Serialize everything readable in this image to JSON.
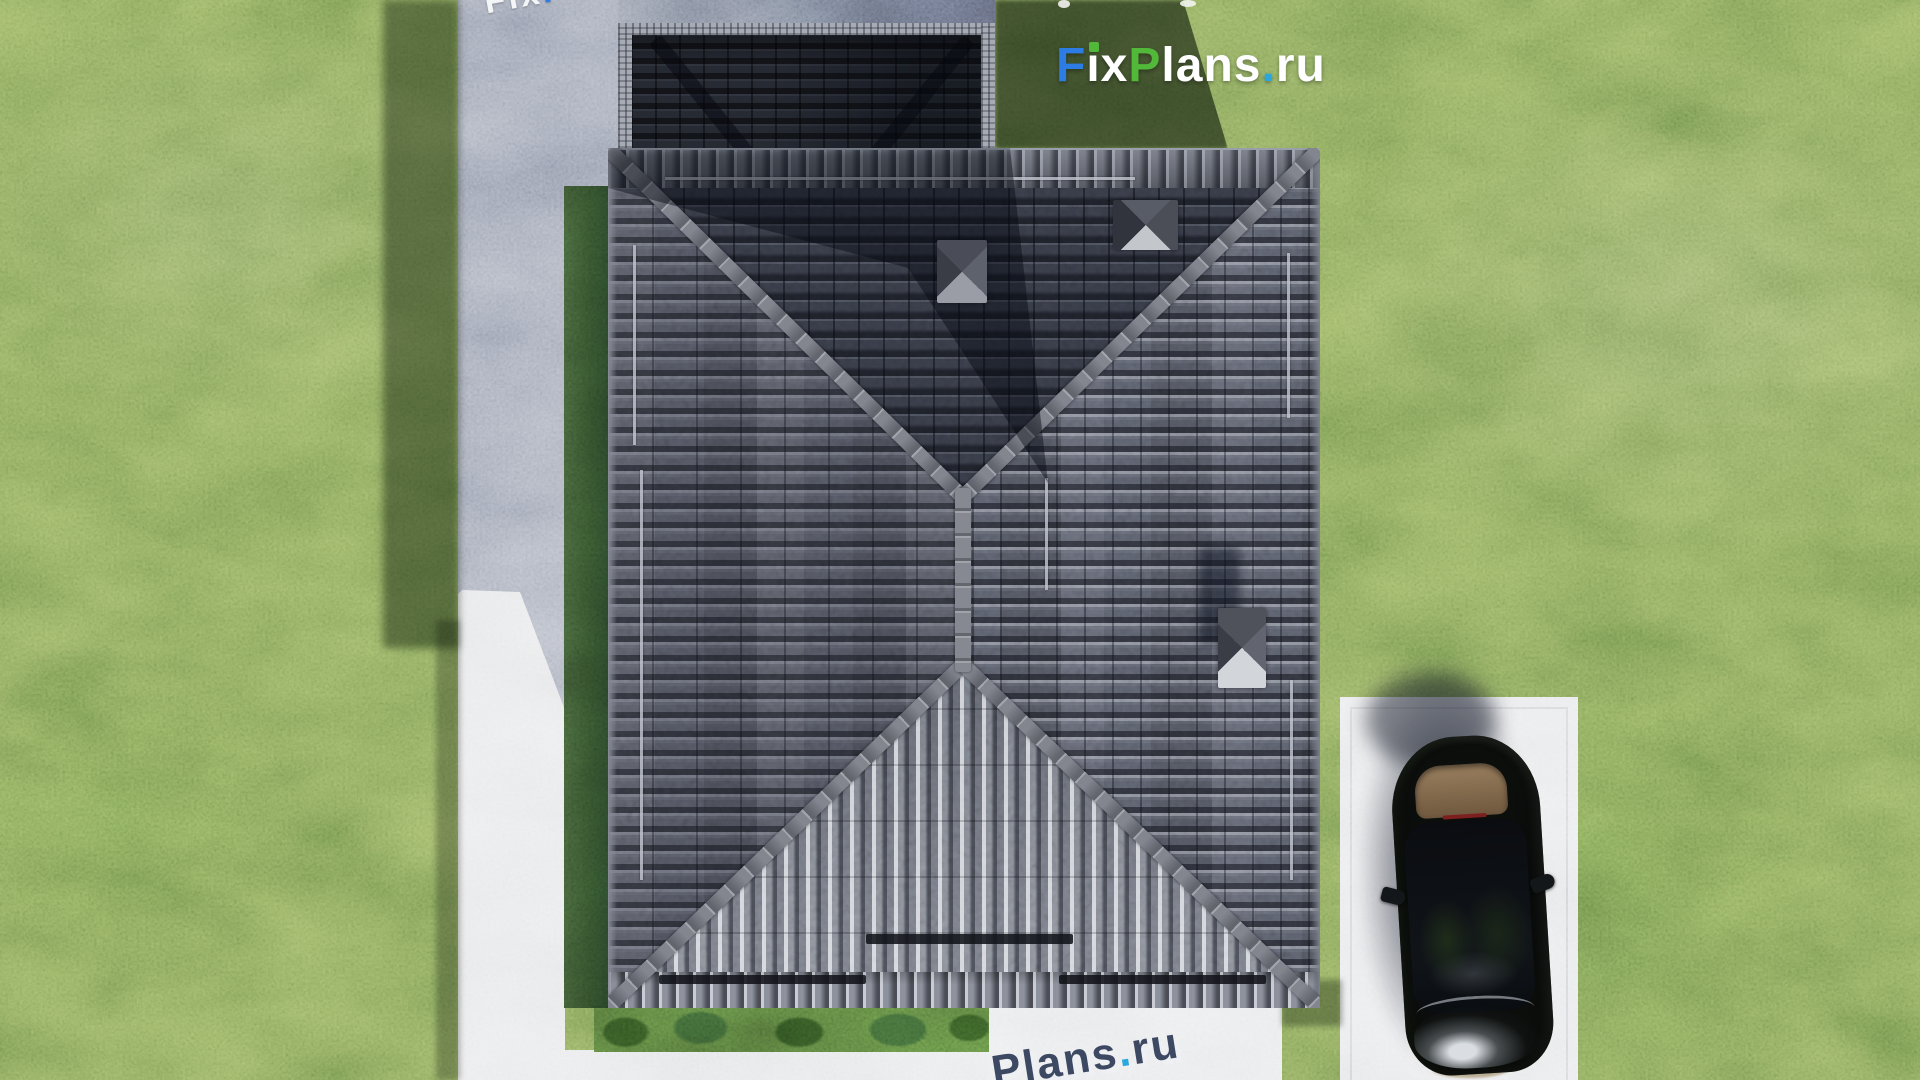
{
  "watermarks": {
    "main": {
      "text": "FixPlans.ru",
      "letters": [
        {
          "ch": "F",
          "color": "#2d7ce4"
        },
        {
          "ch": "i",
          "color": "#ffffff",
          "dot_color": "#52b83a"
        },
        {
          "ch": "x",
          "color": "#ffffff"
        },
        {
          "ch": "P",
          "color": "#52b83a"
        },
        {
          "ch": "l",
          "color": "#ffffff"
        },
        {
          "ch": "a",
          "color": "#ffffff"
        },
        {
          "ch": "n",
          "color": "#ffffff"
        },
        {
          "ch": "s",
          "color": "#ffffff"
        },
        {
          "ch": ".",
          "color": "#2aa7df"
        },
        {
          "ch": "r",
          "color": "#ffffff"
        },
        {
          "ch": "u",
          "color": "#ffffff"
        }
      ]
    },
    "top_left": {
      "text": "FixPlans.ru",
      "letters": [
        {
          "ch": "F",
          "color": "#f4f5f7"
        },
        {
          "ch": "i",
          "color": "#f4f5f7"
        },
        {
          "ch": "x",
          "color": "#f4f5f7"
        },
        {
          "ch": "P",
          "color": "#2d7ce4"
        },
        {
          "ch": "l",
          "color": "#f4f5f7"
        },
        {
          "ch": "a",
          "color": "#f4f5f7"
        },
        {
          "ch": "n",
          "color": "#f4f5f7"
        },
        {
          "ch": "s",
          "color": "#f4f5f7"
        },
        {
          "ch": ".",
          "color": "#f4f5f7"
        },
        {
          "ch": "r",
          "color": "#52b83a"
        },
        {
          "ch": "u",
          "color": "#f4f5f7"
        }
      ]
    },
    "bottom": {
      "text": "Plans.ru",
      "shadow_color": "#eef0f3",
      "letters": [
        {
          "ch": "P",
          "color": "#3d4862"
        },
        {
          "ch": "l",
          "color": "#3d4862"
        },
        {
          "ch": "a",
          "color": "#3d4862"
        },
        {
          "ch": "n",
          "color": "#3d4862"
        },
        {
          "ch": "s",
          "color": "#3d4862"
        },
        {
          "ch": ".",
          "color": "#2aa7df"
        },
        {
          "ch": "r",
          "color": "#3d4862"
        },
        {
          "ch": "u",
          "color": "#3d4862"
        }
      ]
    }
  },
  "scene": {
    "palette": {
      "grass_sunlit": "#6f8e4b",
      "grass_shadow": "#2f4527",
      "concrete_sunlit": "#e4e5e7",
      "concrete_shadow": "#8e95a8",
      "roof_plane_north": "#343843",
      "roof_plane_west": "#4d505b",
      "roof_plane_east": "#575b67",
      "roof_plane_south": "#60646f",
      "ridge_cap": "#83868f",
      "garage_roof": "#262a33",
      "car_body": "#0a0c0b",
      "car_parcel_shelf": "#94795a",
      "logo_blue": "#2d7ce4",
      "logo_green": "#52b83a",
      "logo_dot_blue": "#2aa7df"
    }
  }
}
